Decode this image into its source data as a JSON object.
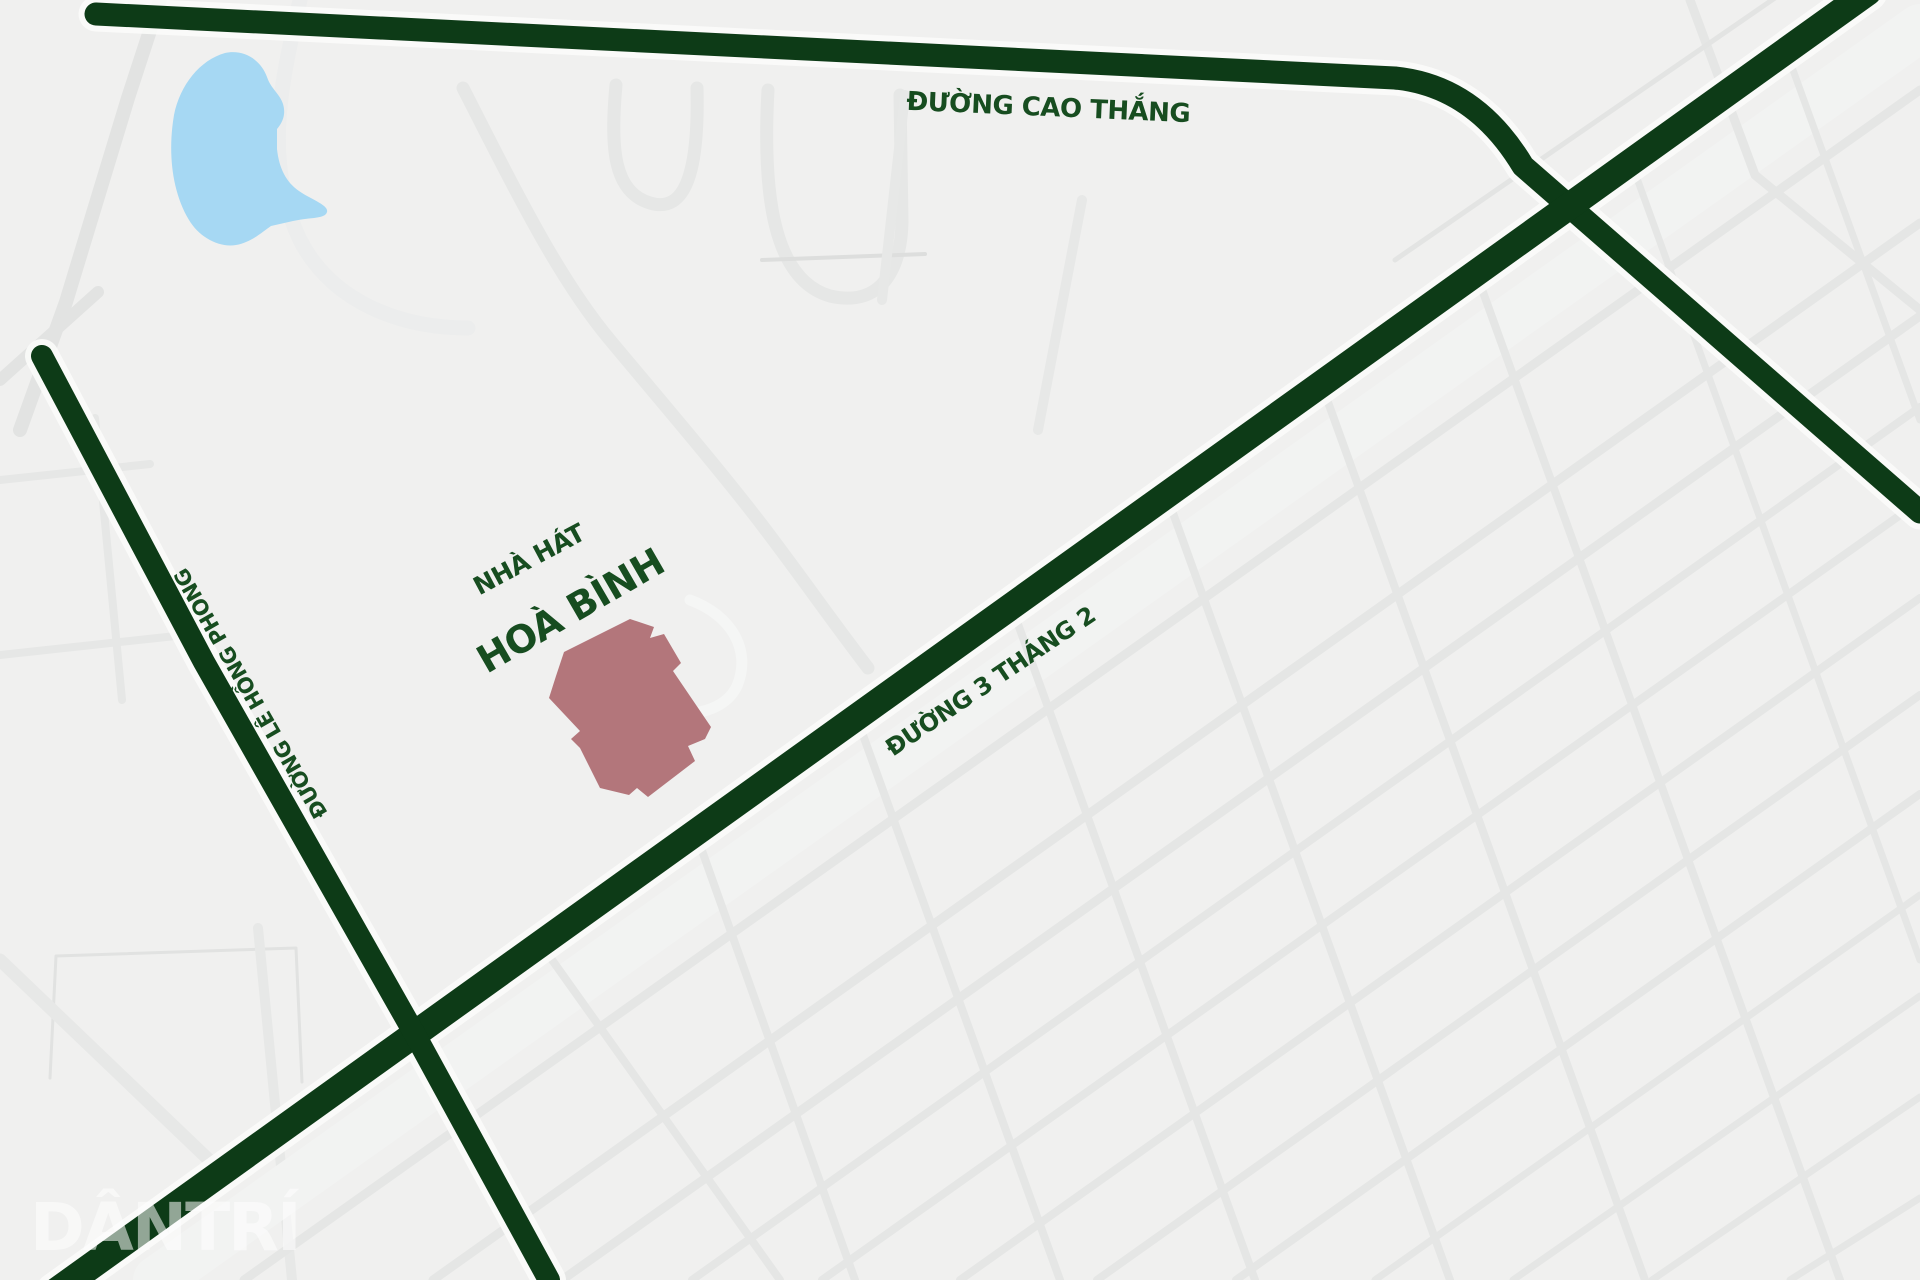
{
  "map": {
    "background": "#f0f0ef",
    "road_color": "#0d3b17",
    "casing_color": "#fbfbfa",
    "label_color": "#174d20",
    "pond_color": "#a6d8f3",
    "building_color": "#b3767b",
    "watermark": {
      "text": "DÂNTRÍ",
      "x": 30,
      "y": 1250,
      "size": 66,
      "color": "#ffffff",
      "opacity": 0.55
    },
    "major_roads": [
      {
        "name": "road-duong-cao-thang",
        "d": "M 96,14 L 1395,78 Q 1475,86 1523,166 L 1920,512",
        "w": 23
      },
      {
        "name": "road-duong-3-thang-2",
        "d": "M 55,1292 L 1868,-8",
        "w": 27
      },
      {
        "name": "road-duong-le-hong-phong",
        "d": "M 42,356 L 204,662 L 413,1031 L 549,1280",
        "w": 22
      }
    ],
    "labels": [
      {
        "name": "label-duong-cao-thang",
        "text": "ĐƯỜNG CAO THẮNG",
        "x": 1048,
        "y": 116,
        "rotate": 2.5,
        "size": 26
      },
      {
        "name": "label-duong-le-hong-phong",
        "text": "ĐƯỜNG LÊ HỒNG PHONG",
        "x": 257,
        "y": 690,
        "rotate": -120,
        "size": 21
      },
      {
        "name": "label-duong-3-thang-2",
        "text": "ĐƯỜNG 3 THÁNG 2",
        "x": 995,
        "y": 688,
        "rotate": -34,
        "size": 24
      },
      {
        "name": "label-nha-hat",
        "text": "NHÀ HÁT",
        "x": 533,
        "y": 567,
        "rotate": -28,
        "size": 25
      },
      {
        "name": "label-hoa-binh",
        "text": "HOÀ BÌNH",
        "x": 577,
        "y": 622,
        "rotate": -30,
        "size": 38
      }
    ],
    "building": {
      "name": "hoa-binh-theater-building",
      "points": "630,619 654,627 650,638 664,634 681,663 673,671 711,727 705,739 688,746 695,761 648,797 637,788 629,795 600,788 580,748 571,739 580,731 549,698 556,676 564,652"
    },
    "pond": {
      "name": "pond",
      "d": "M 225,53 C 200,60 180,85 174,115 C 168,150 171,190 189,220 C 199,237 219,248 236,245 C 252,242 262,232 271,226 L 293,221 C 312,217 325,219 327,212 C 329,205 310,199 299,191 C 286,182 279,168 277,149 L 277,129 C 283,122 286,114 283,104 C 280,94 271,89 267,77 C 261,60 244,49 225,53 Z"
    },
    "minor_roads": [
      {
        "d": "M 160,0 L 128,98 L 66,302 L 20,430",
        "w": 14,
        "c": "#e2e3e2"
      },
      {
        "d": "M 98,292 L 0,380",
        "w": 12,
        "c": "#e2e3e2"
      },
      {
        "d": "M 463,88 C 520,200 560,280 610,340 C 660,400 720,470 762,525 C 800,575 835,625 868,668",
        "w": 13,
        "c": "#e6e7e6"
      },
      {
        "d": "M 616,85 C 610,150 614,192 650,203 C 686,214 699,170 697,88",
        "w": 13,
        "c": "#e6e7e6"
      },
      {
        "d": "M 768,90 C 762,200 775,280 830,296 C 882,308 901,268 902,222 L 900,95",
        "w": 13,
        "c": "#e6e7e6"
      },
      {
        "d": "M 762,260 L 925,254",
        "w": 4,
        "c": "#dddedd"
      },
      {
        "d": "M 300,0 C 282,80 262,160 300,240 C 332,302 400,328 468,328",
        "w": 15,
        "c": "#eceded"
      },
      {
        "d": "M 690,600 C 731,615 752,650 737,686 C 727,707 700,716 678,712",
        "w": 11,
        "c": "#f5f6f5"
      },
      {
        "d": "M 50,1078 L 56,956 L 296,948 L 302,1082",
        "w": 3,
        "c": "#e1e2e1"
      },
      {
        "d": "M 0,960 L 230,1180",
        "w": 13,
        "c": "#e7e8e7"
      },
      {
        "d": "M 258,928 L 292,1280",
        "w": 10,
        "c": "#e7e8e7"
      },
      {
        "d": "M 0,480 L 150,464",
        "w": 8,
        "c": "#e6e7e6"
      },
      {
        "d": "M 0,655 L 185,635",
        "w": 8,
        "c": "#e6e7e6"
      },
      {
        "d": "M 95,418 L 122,700",
        "w": 8,
        "c": "#e6e7e6"
      },
      {
        "d": "M 157,1280 L 1920,28",
        "w": 48,
        "c": "#f2f3f2"
      },
      {
        "d": "M 244,1280 L 1920,90",
        "w": 9,
        "c": "#e5e6e5"
      },
      {
        "d": "M 433,1280 L 1920,223",
        "w": 9,
        "c": "#e5e6e5"
      },
      {
        "d": "M 562,1280 L 1920,316",
        "w": 9,
        "c": "#e5e6e5"
      },
      {
        "d": "M 692,1280 L 1920,407",
        "w": 8,
        "c": "#e5e6e5"
      },
      {
        "d": "M 822,1280 L 1920,501",
        "w": 8,
        "c": "#e5e6e5"
      },
      {
        "d": "M 960,1280 L 1920,598",
        "w": 8,
        "c": "#e5e6e5"
      },
      {
        "d": "M 1097,1280 L 1920,695",
        "w": 8,
        "c": "#e5e6e5"
      },
      {
        "d": "M 1236,1280 L 1920,794",
        "w": 8,
        "c": "#e5e6e5"
      },
      {
        "d": "M 1375,1280 L 1920,895",
        "w": 7,
        "c": "#e5e6e5"
      },
      {
        "d": "M 1513,1280 L 1920,996",
        "w": 7,
        "c": "#e5e6e5"
      },
      {
        "d": "M 1652,1280 L 1920,1097",
        "w": 7,
        "c": "#e5e6e5"
      },
      {
        "d": "M 1790,1280 L 1920,1198",
        "w": 7,
        "c": "#e5e6e5"
      },
      {
        "d": "M 700,845 L 855,1280",
        "w": 8,
        "c": "#e5e6e5"
      },
      {
        "d": "M 855,713 L 1060,1280",
        "w": 8,
        "c": "#e5e6e5"
      },
      {
        "d": "M 1010,602 L 1255,1280",
        "w": 8,
        "c": "#e5e6e5"
      },
      {
        "d": "M 1165,491 L 1450,1280",
        "w": 8,
        "c": "#e5e6e5"
      },
      {
        "d": "M 1320,380 L 1645,1280",
        "w": 8,
        "c": "#e5e6e5"
      },
      {
        "d": "M 1475,270 L 1840,1280",
        "w": 8,
        "c": "#e5e6e5"
      },
      {
        "d": "M 1630,159 L 1920,960",
        "w": 7,
        "c": "#e5e6e5"
      },
      {
        "d": "M 1785,48 L 1920,420",
        "w": 7,
        "c": "#e5e6e5"
      },
      {
        "d": "M 545,950 L 780,1280",
        "w": 8,
        "c": "#e5e6e5"
      },
      {
        "d": "M 1690,0 L 1755,175 L 1920,310",
        "w": 9,
        "c": "#e5e6e5"
      },
      {
        "d": "M 1395,260 L 1830,-40",
        "w": 5,
        "c": "#e3e4e3"
      },
      {
        "d": "M 905,95 L 882,300",
        "w": 10,
        "c": "#e7e8e7"
      },
      {
        "d": "M 1082,200 L 1038,430",
        "w": 10,
        "c": "#e7e8e7"
      }
    ]
  }
}
